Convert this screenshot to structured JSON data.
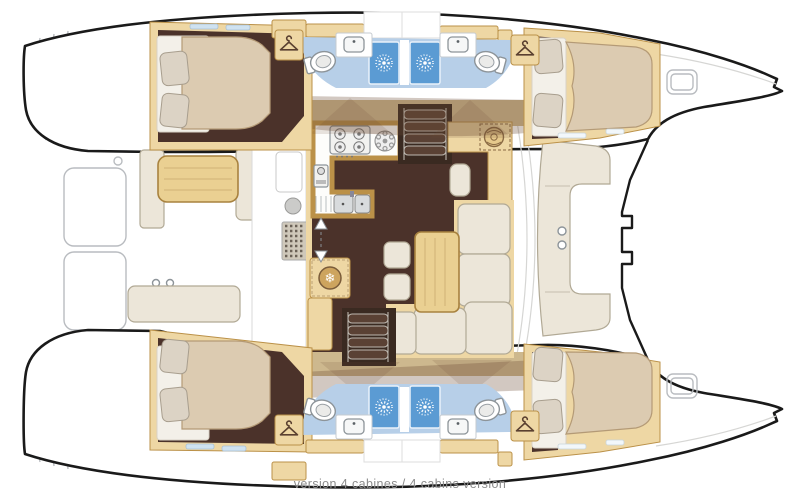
{
  "caption": {
    "text": "version 4 cabines / 4 cabins version"
  },
  "icons": {
    "fridge_snowflake": "❄"
  },
  "colors": {
    "floor": "#4b322a",
    "wood": "#eed7a4",
    "woodEdge": "#bb9148",
    "tableWood": "#ead092",
    "tableEdge": "#a8823f",
    "walkway": "#cdb88e",
    "cream": "#ece6d9",
    "creamEdge": "#b1a995",
    "bed": "#dccbb1",
    "bedEdge": "#b49a76",
    "pillow": "#dcd3c5",
    "pillowEdge": "#a89e8e",
    "bathFloor": "#b7cfe8",
    "shower": "#5b9bd3",
    "stairTread": "#5a4134",
    "stairWell": "#3a2a21",
    "hullOutline": "#1a1a1a",
    "deckLine": "#b9bcc0",
    "doorShade": "#6b4a33",
    "captionText": "#8c8c8c",
    "hanger": "#5a4030",
    "fridgeDisc": "#cda45e",
    "fridgeRing": "#7a5c3a"
  }
}
